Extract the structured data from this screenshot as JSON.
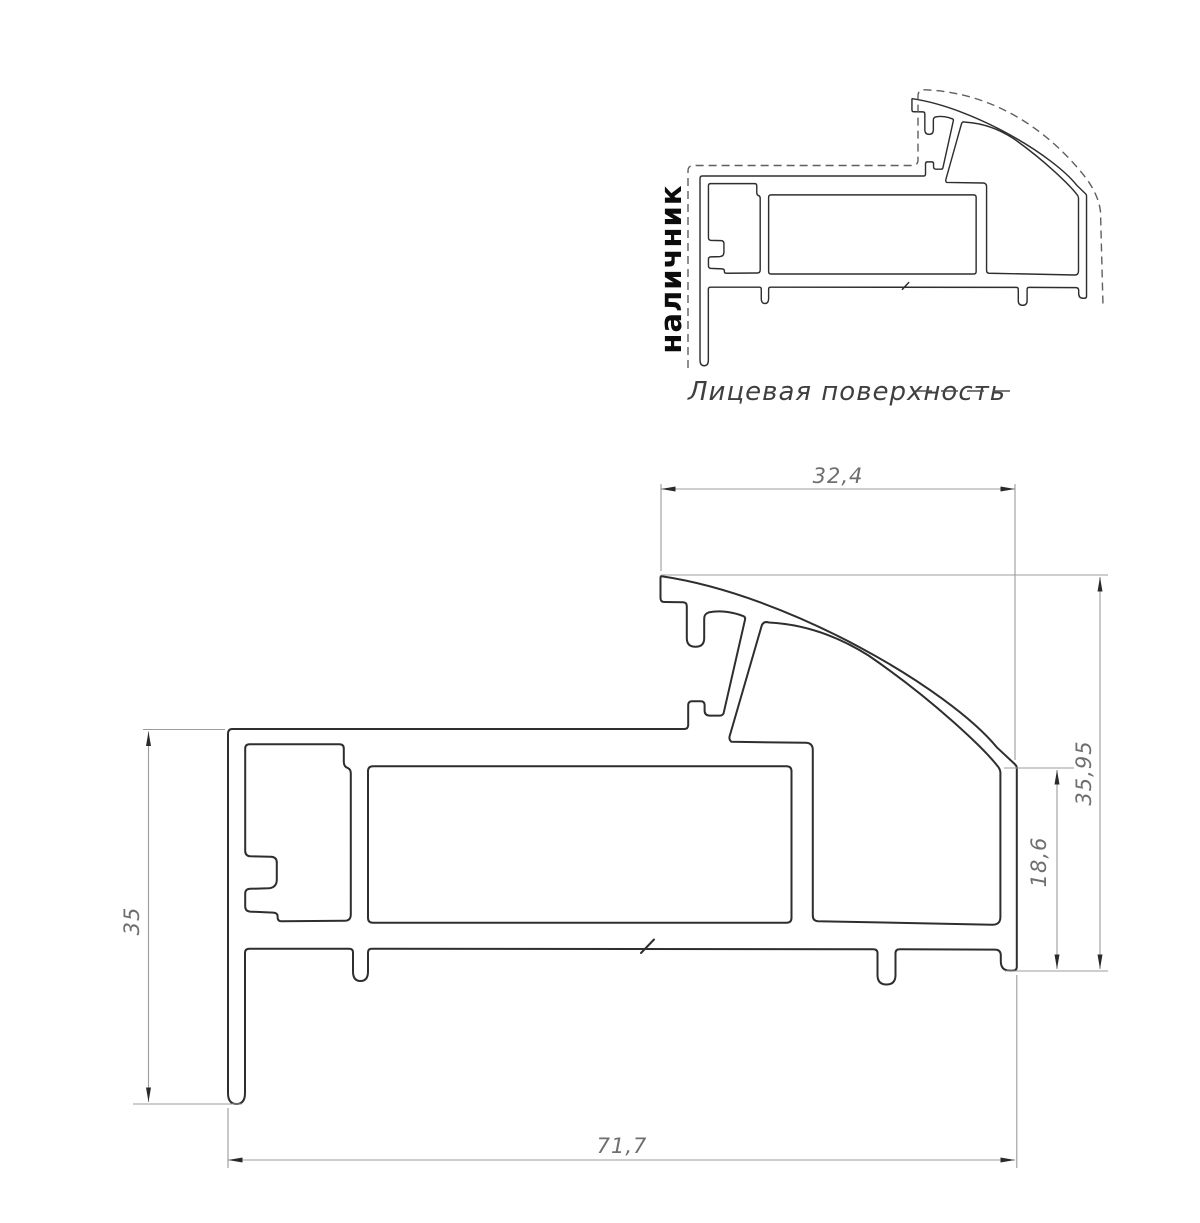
{
  "drawing": {
    "type": "technical-profile-cross-section",
    "casing_label": "наличник",
    "legend": {
      "label": "Лицевая поверхность",
      "line_style": "dashed"
    },
    "dimensions": {
      "top_width": "32,4",
      "right_outer_height": "35,95",
      "right_inner_height": "18,6",
      "left_height": "35",
      "bottom_width": "71,7"
    },
    "colors": {
      "background": "#ffffff",
      "profile_outline": "#2e2e2e",
      "dashed_outline": "#5f5f5f",
      "dimension_lines": "#9c9c9c",
      "dimension_text": "#6f6f6f",
      "casing_label_text": "#0c0c0c",
      "legend_text": "#3f3f3f"
    }
  }
}
